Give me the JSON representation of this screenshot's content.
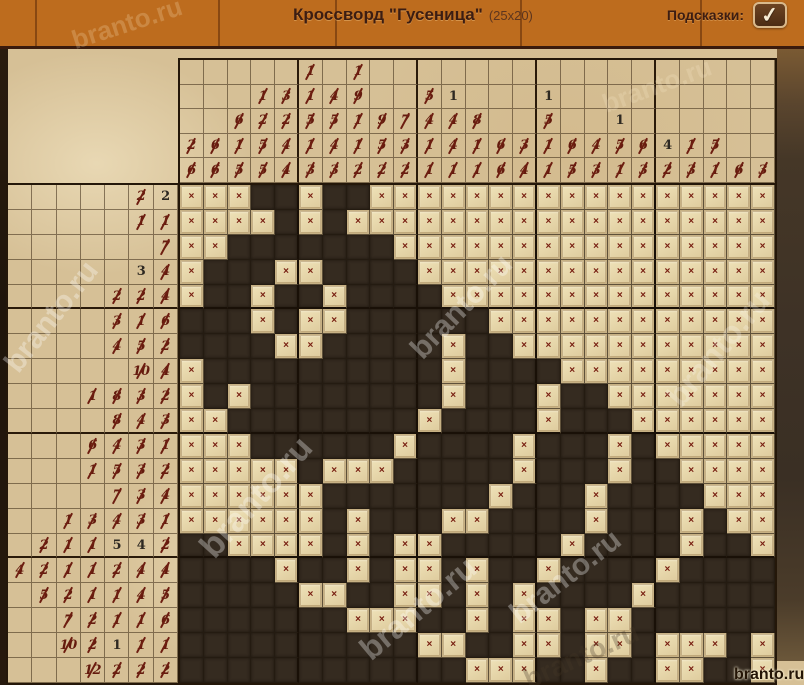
{
  "header": {
    "title": "Кроссворд \"Гусеница\"",
    "size_label": "(25x20)",
    "hints_label": "Подсказки:",
    "check_icon": "✓"
  },
  "watermark": {
    "text": "branto.ru",
    "corner_text": "branto.ru"
  },
  "colors": {
    "wood": "#bd6c1e",
    "parchment": "#d6c096",
    "filled_cell": "#352b20",
    "crossed_tile": "#e8d9ae",
    "cross_mark": "#771d10",
    "clue_struck": "#641b0e",
    "clue_plain": "#2e2922"
  },
  "puzzle": {
    "cols": 25,
    "rows": 20,
    "cross_mark": "×",
    "cell_legend": "F=filled dark cell, X=crossed-out cell",
    "clue_format": "[value, struck(1)/plain(0)]",
    "col_clues": [
      [
        [
          2,
          1
        ],
        [
          6,
          1
        ]
      ],
      [
        [
          6,
          1
        ],
        [
          6,
          1
        ]
      ],
      [
        [
          6,
          1
        ],
        [
          1,
          1
        ],
        [
          5,
          1
        ]
      ],
      [
        [
          1,
          1
        ],
        [
          2,
          1
        ],
        [
          5,
          1
        ],
        [
          5,
          1
        ]
      ],
      [
        [
          3,
          1
        ],
        [
          2,
          1
        ],
        [
          4,
          1
        ],
        [
          4,
          1
        ]
      ],
      [
        [
          1,
          1
        ],
        [
          1,
          1
        ],
        [
          5,
          1
        ],
        [
          1,
          1
        ],
        [
          3,
          1
        ]
      ],
      [
        [
          4,
          1
        ],
        [
          5,
          1
        ],
        [
          4,
          1
        ],
        [
          3,
          1
        ]
      ],
      [
        [
          1,
          1
        ],
        [
          9,
          1
        ],
        [
          1,
          1
        ],
        [
          1,
          1
        ],
        [
          2,
          1
        ]
      ],
      [
        [
          9,
          1
        ],
        [
          5,
          1
        ],
        [
          2,
          1
        ]
      ],
      [
        [
          7,
          1
        ],
        [
          3,
          1
        ],
        [
          2,
          1
        ]
      ],
      [
        [
          5,
          1
        ],
        [
          4,
          1
        ],
        [
          1,
          1
        ],
        [
          1,
          1
        ]
      ],
      [
        [
          1,
          0
        ],
        [
          4,
          1
        ],
        [
          4,
          1
        ],
        [
          1,
          1
        ]
      ],
      [
        [
          8,
          1
        ],
        [
          1,
          1
        ],
        [
          1,
          1
        ]
      ],
      [
        [
          6,
          1
        ],
        [
          6,
          1
        ]
      ],
      [
        [
          3,
          1
        ],
        [
          4,
          1
        ]
      ],
      [
        [
          1,
          0
        ],
        [
          5,
          1
        ],
        [
          1,
          1
        ],
        [
          1,
          1
        ]
      ],
      [
        [
          6,
          1
        ],
        [
          5,
          1
        ]
      ],
      [
        [
          4,
          1
        ],
        [
          3,
          1
        ]
      ],
      [
        [
          1,
          0
        ],
        [
          5,
          1
        ],
        [
          1,
          1
        ]
      ],
      [
        [
          6,
          1
        ],
        [
          3,
          1
        ]
      ],
      [
        [
          4,
          0
        ],
        [
          2,
          1
        ]
      ],
      [
        [
          1,
          1
        ],
        [
          3,
          1
        ]
      ],
      [
        [
          5,
          1
        ],
        [
          1,
          1
        ]
      ],
      [
        [
          6,
          1
        ]
      ],
      [
        [
          3,
          1
        ]
      ]
    ],
    "row_clues": [
      [
        [
          2,
          1
        ],
        [
          2,
          0
        ]
      ],
      [
        [
          1,
          1
        ],
        [
          1,
          1
        ]
      ],
      [
        [
          7,
          1
        ]
      ],
      [
        [
          3,
          0
        ],
        [
          4,
          1
        ]
      ],
      [
        [
          2,
          1
        ],
        [
          2,
          1
        ],
        [
          4,
          1
        ]
      ],
      [
        [
          3,
          1
        ],
        [
          1,
          1
        ],
        [
          6,
          1
        ]
      ],
      [
        [
          4,
          1
        ],
        [
          5,
          1
        ],
        [
          2,
          1
        ]
      ],
      [
        [
          10,
          1
        ],
        [
          4,
          1
        ]
      ],
      [
        [
          1,
          1
        ],
        [
          8,
          1
        ],
        [
          3,
          1
        ],
        [
          2,
          1
        ]
      ],
      [
        [
          8,
          1
        ],
        [
          4,
          1
        ],
        [
          3,
          1
        ]
      ],
      [
        [
          6,
          1
        ],
        [
          4,
          1
        ],
        [
          3,
          1
        ],
        [
          1,
          1
        ]
      ],
      [
        [
          1,
          1
        ],
        [
          5,
          1
        ],
        [
          3,
          1
        ],
        [
          2,
          1
        ]
      ],
      [
        [
          7,
          1
        ],
        [
          3,
          1
        ],
        [
          4,
          1
        ]
      ],
      [
        [
          1,
          1
        ],
        [
          3,
          1
        ],
        [
          4,
          1
        ],
        [
          3,
          1
        ],
        [
          1,
          1
        ]
      ],
      [
        [
          2,
          1
        ],
        [
          1,
          1
        ],
        [
          1,
          1
        ],
        [
          5,
          0
        ],
        [
          4,
          0
        ],
        [
          2,
          1
        ]
      ],
      [
        [
          4,
          1
        ],
        [
          2,
          1
        ],
        [
          1,
          1
        ],
        [
          1,
          1
        ],
        [
          2,
          1
        ],
        [
          4,
          1
        ],
        [
          4,
          1
        ]
      ],
      [
        [
          5,
          1
        ],
        [
          2,
          1
        ],
        [
          1,
          1
        ],
        [
          1,
          1
        ],
        [
          4,
          1
        ],
        [
          5,
          1
        ]
      ],
      [
        [
          7,
          1
        ],
        [
          2,
          1
        ],
        [
          1,
          1
        ],
        [
          1,
          1
        ],
        [
          6,
          1
        ]
      ],
      [
        [
          10,
          1
        ],
        [
          2,
          1
        ],
        [
          1,
          0
        ],
        [
          1,
          1
        ],
        [
          1,
          1
        ]
      ],
      [
        [
          12,
          1
        ],
        [
          2,
          1
        ],
        [
          2,
          1
        ],
        [
          2,
          1
        ]
      ]
    ],
    "cells": [
      "XXXFFXFFXXXXXXXXXXXXXXXXX",
      "XXXXFXFXXXXXXXXXXXXXXXXXX",
      "XXFFFFFFFXXXXXXXXXXXXXXXX",
      "XFFFXXFFFFXXXXXXXXXXXXXXX",
      "XFFXFFXFFFFXXXXXXXXXXXXXX",
      "FFFXFXXFFFFFFXXXXXXXXXXXX",
      "FFFFXXFFFFFXFFXXXXXXXXXXX",
      "XFFFFFFFFFFXFFFFXXXXXXXXX",
      "XFXFFFFFFFFXFFFXFFXXXXXXX",
      "XXFFFFFFFFXFFFFXFFFXXXXXX",
      "XXXFFFFFFXFFFFXFFFXFXXXXX",
      "XXXXXFXXXFFFFFXFFFXFFXXXX",
      "XXXXXXFFFFFFFXFFFXFFFFXXX",
      "XXXXXXFXFFFXXFFFFXFFFXFXX",
      "FFXXXXFXFXXFFFFFXFFFFXFFX",
      "FFFFXFFXFXXFXFFXFFFFXFFFF",
      "FFFFFXXFFXXFXFXFFFFXFFFFF",
      "FFFFFFFXXXFFXFXXFXXFFFFFF",
      "FFFFFFFFFFXXFFXXFXXFXXXFX",
      "FFFFFFFFFFFFXXXFFXFFXXFFX"
    ]
  }
}
